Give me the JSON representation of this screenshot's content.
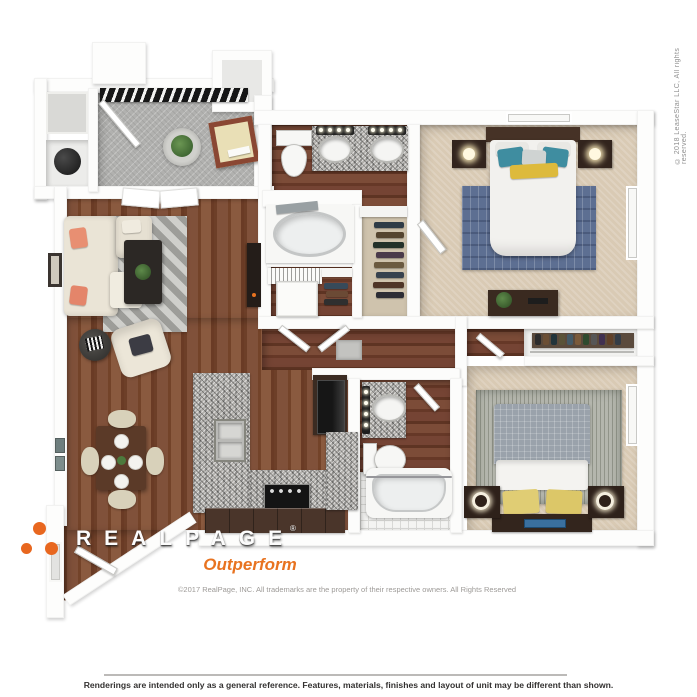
{
  "branding": {
    "logo_text": "REALPAGE",
    "registered_mark": "®",
    "tagline": "Outperform",
    "copyright_line": "©2017 RealPage, INC.  All trademarks are the property of their respective owners.  All Rights Reserved"
  },
  "watermark": {
    "side_text": "© 2018 LeaseStar LLC, All rights reserved."
  },
  "footer": {
    "disclaimer": "Renderings are intended only as a general reference. Features, materials, finishes and layout of unit may be different than shown."
  },
  "colors": {
    "accent_orange": "#E8671F",
    "tagline_orange": "#E87320",
    "wood_floor": "#7A4A30",
    "bath_wood_floor": "#6A3C2A",
    "carpet": "#D9CAB4",
    "entry_floor": "#B1B1AF",
    "granite": "#B2B0AC",
    "cabinet_brown": "#4A352A",
    "pillow_teal": "#3F8DA0",
    "pillow_coral": "#E88F72",
    "pillow_yellow": "#DFC35C",
    "rug_blue": "#5D6F92",
    "copy_gray": "#9D9A97",
    "disclaimer_gray": "#333130"
  }
}
